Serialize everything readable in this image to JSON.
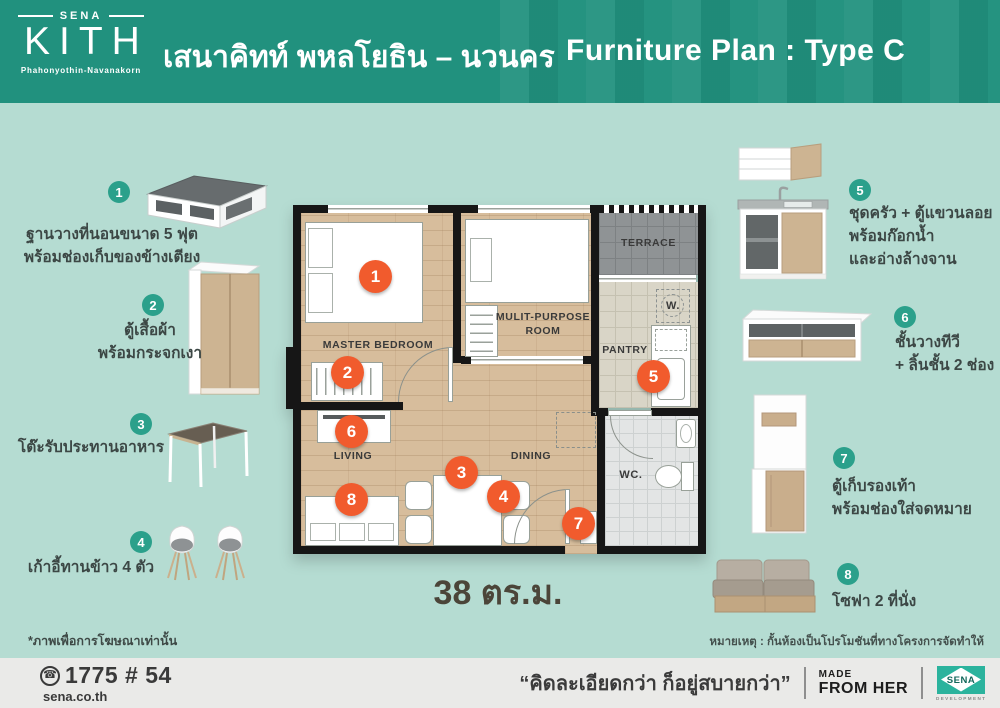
{
  "header": {
    "logo": {
      "brand": "SENA",
      "name": "KITH",
      "location": "Phahonyothin-Navanakorn"
    },
    "project_title_th": "เสนาคิทท์ พหลโยธิน – นวนคร",
    "plan_title": "Furniture Plan : Type C"
  },
  "furniture_items_left": [
    {
      "number": "1",
      "label": "ฐานวางที่นอนขนาด 5 ฟุต\nพร้อมช่องเก็บของข้างเตียง"
    },
    {
      "number": "2",
      "label": "ตู้เสื้อผ้า\nพร้อมกระจกเงา"
    },
    {
      "number": "3",
      "label": "โต๊ะรับประทานอาหาร"
    },
    {
      "number": "4",
      "label": "เก้าอี้ทานข้าว 4 ตัว"
    }
  ],
  "furniture_items_right": [
    {
      "number": "5",
      "label": "ชุดครัว + ตู้แขวนลอย\nพร้อมก๊อกน้ำ\nและอ่างล้างจาน"
    },
    {
      "number": "6",
      "label": "ชั้นวางทีวี\n+ ลิ้นชั้น 2 ช่อง"
    },
    {
      "number": "7",
      "label": "ตู้เก็บรองเท้า\nพร้อมช่องใส่จดหมาย"
    },
    {
      "number": "8",
      "label": "โซฟา 2 ที่นั่ง"
    }
  ],
  "floor_plan": {
    "rooms": {
      "master_bedroom": "MASTER BEDROOM",
      "multi_purpose": "MULIT-PURPOSE\nROOM",
      "terrace": "TERRACE",
      "pantry": "PANTRY",
      "living": "LIVING",
      "dining": "DINING",
      "washer": "W.",
      "wc": "WC."
    },
    "markers": [
      "1",
      "2",
      "3",
      "4",
      "5",
      "6",
      "7",
      "8"
    ],
    "area": "38 ตร.ม."
  },
  "notes": {
    "disclaimer": "*ภาพเพื่อการโฆษณาเท่านั้น",
    "remark": "หมายเหตุ : กั้นห้องเป็นโปรโมชันที่ทางโครงการจัดทำให้"
  },
  "footer": {
    "phone_icon": "☎",
    "phone": "1775 # 54",
    "website": "sena.co.th",
    "slogan": "“คิดละเอียดกว่า ก็อยู่สบายกว่า”",
    "mfh_line1": "MADE",
    "mfh_line2": "FROM HER",
    "sena_text": "SENA",
    "sena_sub": "DEVELOPMENT"
  },
  "colors": {
    "header_teal": "#21917e",
    "background_mint": "#b5dcd2",
    "marker_orange": "#f15b2d",
    "badge_teal": "#2ba08b",
    "footer_gray": "#eaeae8"
  }
}
